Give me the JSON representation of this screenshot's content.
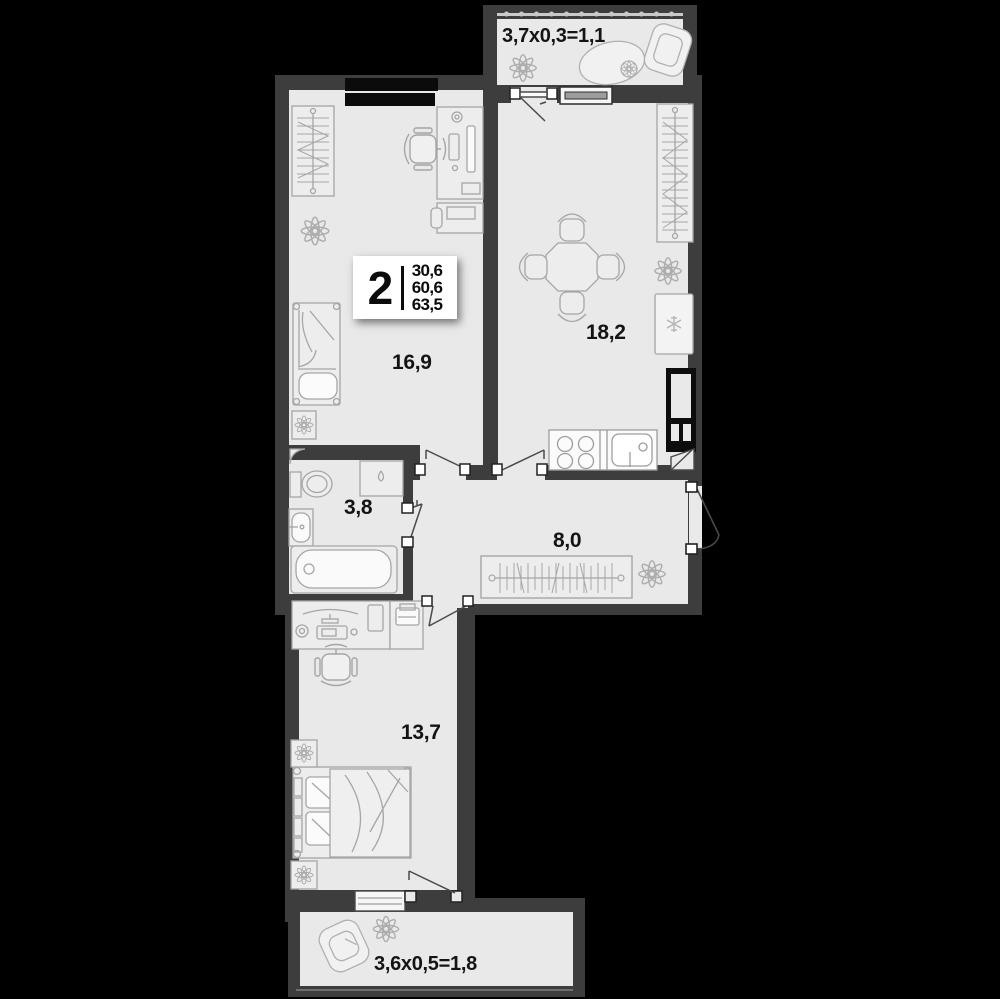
{
  "badge": {
    "rooms_count": "2",
    "areas": [
      "30,6",
      "60,6",
      "63,5"
    ]
  },
  "labels": {
    "living_room": "16,9",
    "kitchen_living": "18,2",
    "bathroom": "3,8",
    "hallway": "8,0",
    "bedroom": "13,7",
    "balcony_top": "3,7x0,3=1,1",
    "balcony_bottom": "3,6x0,5=1,8"
  },
  "colors": {
    "background": "#000000",
    "wall": "#3d3d3d",
    "floor": "#e9e9e9",
    "niche": "#0b0b0b",
    "text": "#141414",
    "badge_bg": "#ffffff",
    "furniture_line": "#a6a6a6"
  }
}
